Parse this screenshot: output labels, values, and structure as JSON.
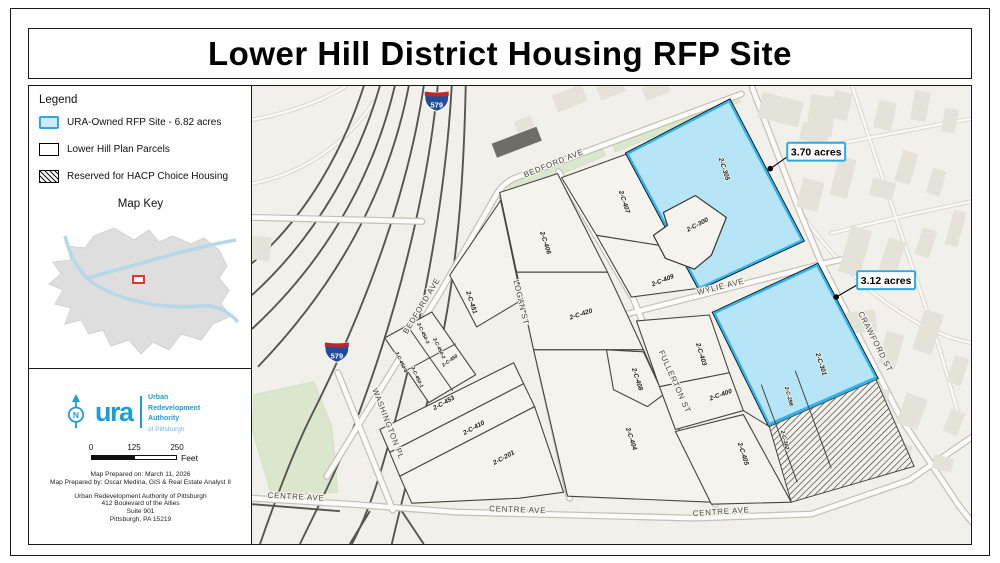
{
  "title": "Lower Hill District Housing RFP Site",
  "legend": {
    "heading": "Legend",
    "items": [
      {
        "label": "URA-Owned RFP Site - 6.82 acres",
        "swatch": "rfp-site-swatch",
        "fill": "#cdeaf9",
        "border": "#2ea9e0"
      },
      {
        "label": "Lower Hill Plan Parcels",
        "swatch": "plan-parcel-swatch",
        "fill": "#ffffff",
        "border": "#000000"
      },
      {
        "label": "Reserved for HACP Choice Housing",
        "swatch": "hatch-swatch",
        "fill": "#ffffff",
        "border": "#000000"
      }
    ],
    "map_key_heading": "Map Key"
  },
  "logo": {
    "acronym": "ura",
    "org_lines": [
      "Urban",
      "Redevelopment",
      "Authority"
    ],
    "org_sub": "of Pittsburgh",
    "north_arrow_letter": "N",
    "brand_color": "#1d9cd8"
  },
  "scale_bar": {
    "ticks": [
      "0",
      "125",
      "250"
    ],
    "unit": "Feet"
  },
  "credits": {
    "lines": [
      "Map Prepared on: March 11, 2026",
      "Map Prepared by: Oscar Medina, GIS & Real Estate Analyst II"
    ],
    "address_lines": [
      "Urban Redevelopment Authority of Pittsburgh",
      "412 Boulevard of the Allies",
      "Suite 901",
      "Pittsburgh, PA 15219"
    ]
  },
  "map": {
    "colors": {
      "background": "#f2f0ea",
      "rfp_fill": "#b7e5f8",
      "rfp_border": "#35b1e8",
      "parcel_line": "#45443f",
      "green": "#dbe7cd",
      "building": "#e4e2d9",
      "highway": "#57554f",
      "callout_border": "#2aa9e1",
      "shield_blue": "#1d4e9e",
      "shield_red": "#c0272d"
    },
    "street_labels": [
      {
        "text": "BEDFORD AVE",
        "x": 303,
        "y": 80,
        "rot": -22
      },
      {
        "text": "BEDFORD AVE",
        "x": 172,
        "y": 222,
        "rot": -59
      },
      {
        "text": "LOGAN ST",
        "x": 267,
        "y": 218,
        "rot": 77
      },
      {
        "text": "WYLIE AVE",
        "x": 470,
        "y": 204,
        "rot": -14
      },
      {
        "text": "FULLERTON ST",
        "x": 421,
        "y": 298,
        "rot": 66
      },
      {
        "text": "CRAWFORD ST",
        "x": 622,
        "y": 258,
        "rot": 63
      },
      {
        "text": "WASHINGTON PL",
        "x": 134,
        "y": 340,
        "rot": 69
      },
      {
        "text": "CENTRE AVE",
        "x": 44,
        "y": 415,
        "rot": 3
      },
      {
        "text": "CENTRE AVE",
        "x": 266,
        "y": 428,
        "rot": 2
      },
      {
        "text": "CENTRE AVE",
        "x": 470,
        "y": 430,
        "rot": -4
      }
    ],
    "parcel_labels": [
      {
        "text": "2-C-305",
        "x": 471,
        "y": 84,
        "rot": 72
      },
      {
        "text": "2-C-300",
        "x": 447,
        "y": 141,
        "rot": -28
      },
      {
        "text": "2-C-407",
        "x": 371,
        "y": 117,
        "rot": 72
      },
      {
        "text": "2-C-409",
        "x": 412,
        "y": 197,
        "rot": -22
      },
      {
        "text": "2-C-406",
        "x": 292,
        "y": 158,
        "rot": 72
      },
      {
        "text": "2-C-420",
        "x": 330,
        "y": 231,
        "rot": -18
      },
      {
        "text": "2-C-451",
        "x": 218,
        "y": 218,
        "rot": 72
      },
      {
        "text": "2-C-450-4",
        "x": 148,
        "y": 278,
        "rot": 65,
        "size": 5
      },
      {
        "text": "2-C-450-3",
        "x": 170,
        "y": 249,
        "rot": 65,
        "size": 5
      },
      {
        "text": "2-C-450-2",
        "x": 186,
        "y": 264,
        "rot": 65,
        "size": 5
      },
      {
        "text": "2-C-450-1",
        "x": 164,
        "y": 293,
        "rot": 65,
        "size": 5
      },
      {
        "text": "2-C-450",
        "x": 199,
        "y": 277,
        "rot": -35,
        "size": 5
      },
      {
        "text": "2-C-453",
        "x": 193,
        "y": 320,
        "rot": -29
      },
      {
        "text": "2-C-410",
        "x": 223,
        "y": 345,
        "rot": -29
      },
      {
        "text": "2-C-201",
        "x": 253,
        "y": 375,
        "rot": -29
      },
      {
        "text": "2-C-408",
        "x": 384,
        "y": 295,
        "rot": 72
      },
      {
        "text": "2-C-404",
        "x": 378,
        "y": 355,
        "rot": 72
      },
      {
        "text": "2-C-403",
        "x": 448,
        "y": 270,
        "rot": 73
      },
      {
        "text": "2-C-400",
        "x": 470,
        "y": 312,
        "rot": -20
      },
      {
        "text": "2-C-405",
        "x": 490,
        "y": 370,
        "rot": 72
      },
      {
        "text": "2-C-301",
        "x": 568,
        "y": 280,
        "rot": 72
      },
      {
        "text": "2-C-298",
        "x": 536,
        "y": 312,
        "rot": 75,
        "size": 5.5
      },
      {
        "text": "2-C-302",
        "x": 532,
        "y": 356,
        "rot": 75,
        "size": 5.5
      }
    ],
    "shields": [
      {
        "label": "579",
        "x": 185,
        "y": 15
      },
      {
        "label": "579",
        "x": 85,
        "y": 267
      }
    ],
    "callouts": [
      {
        "text": "3.70 acres",
        "box_x": 536,
        "box_y": 57,
        "dot_x": 519,
        "dot_y": 83
      },
      {
        "text": "3.12 acres",
        "box_x": 606,
        "box_y": 186,
        "dot_x": 585,
        "dot_y": 212
      }
    ]
  }
}
